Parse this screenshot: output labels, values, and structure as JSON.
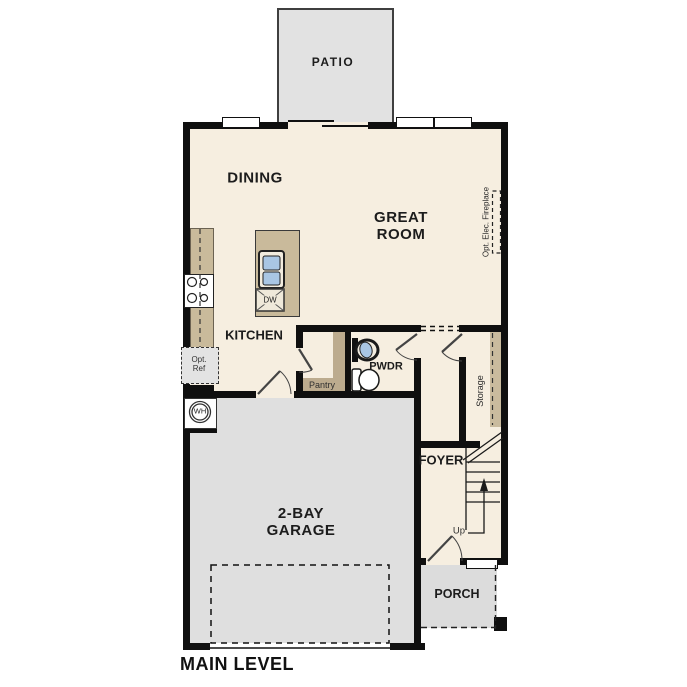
{
  "title": "MAIN LEVEL",
  "rooms": {
    "patio": "PATIO",
    "dining": "DINING",
    "great_room_line1": "GREAT",
    "great_room_line2": "ROOM",
    "kitchen": "KITCHEN",
    "pantry": "Pantry",
    "powder": "PWDR",
    "storage": "Storage",
    "foyer": "FOYER",
    "garage_line1": "2-BAY",
    "garage_line2": "GARAGE",
    "porch": "PORCH"
  },
  "annotations": {
    "up": "Up",
    "water_heater": "WH",
    "dishwasher": "DW",
    "opt_ref_line1": "Opt.",
    "opt_ref_line2": "Ref",
    "opt_fireplace": "Opt. Elec. Fireplace"
  },
  "colors": {
    "wall": "#0f0f0f",
    "floor": "#f6eee0",
    "patio_gray": "#e2e2e2",
    "garage_gray": "#dfdfdf",
    "porch_gray": "#dcdcdc",
    "counter_tan": "#c9ba9b",
    "shelf_tan": "#bcab8e",
    "sink_blue": "#a9c6e4",
    "label_text": "#1c1c1c"
  }
}
